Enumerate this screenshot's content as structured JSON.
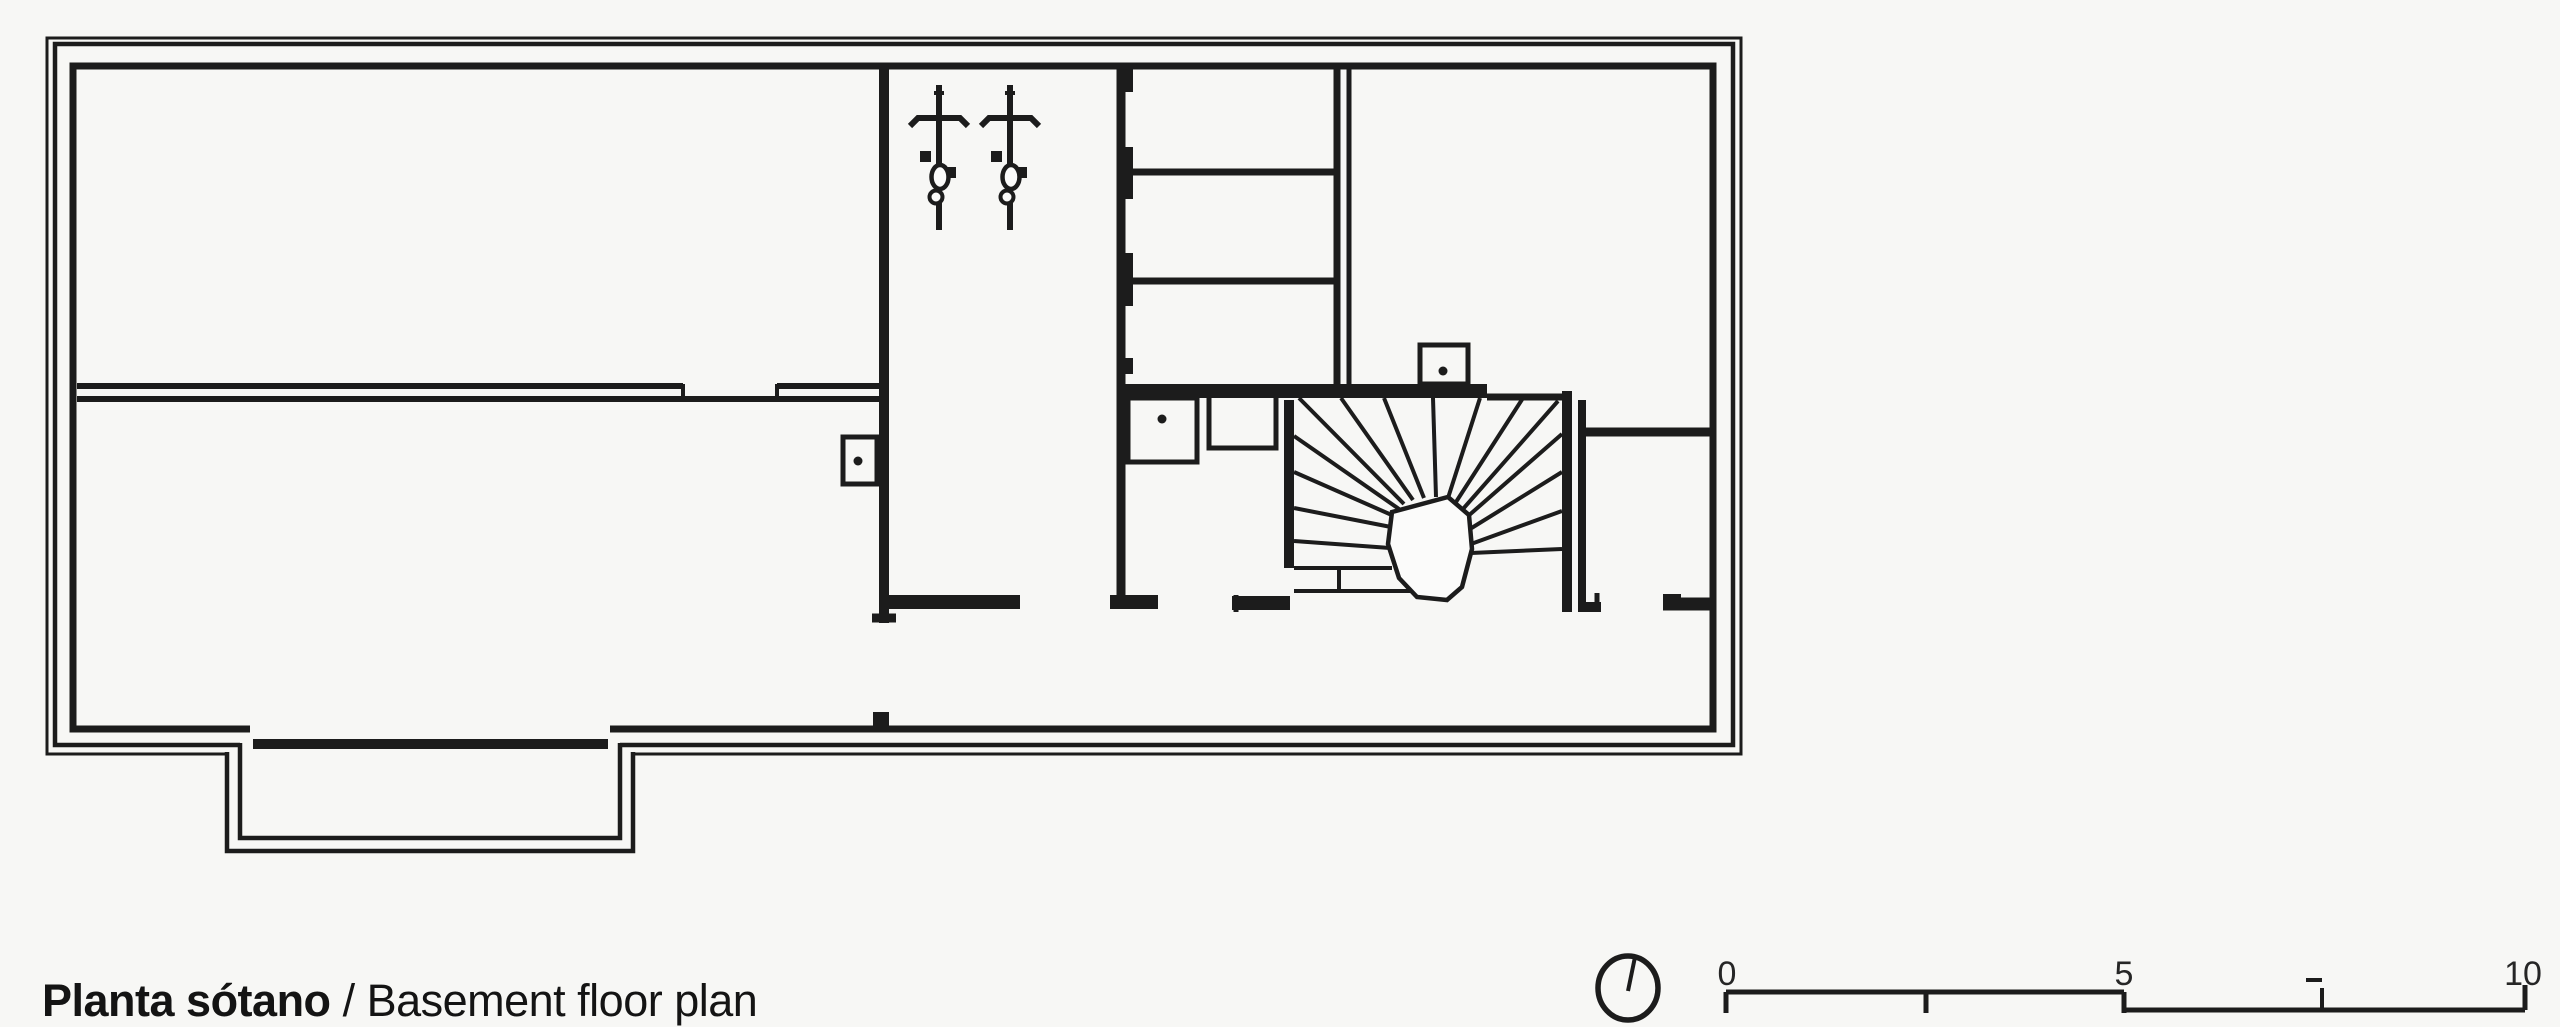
{
  "page": {
    "background": "#f7f7f5",
    "ink": "#1c1c1c",
    "paper": "#fbfbfa"
  },
  "caption": {
    "bold": "Planta sótano ",
    "regular": "/ Basement floor plan"
  },
  "scale_bar": {
    "labels": [
      "0",
      "5",
      "10"
    ]
  },
  "drawing": {
    "type": "architectural-floor-plan",
    "level": "basement",
    "symbols": {
      "north_indicator": "north-indicator-icon",
      "bicycle_count": 2,
      "column_boxes": 3,
      "winder_stair": "fan-stair-icon",
      "storage_shelves": 2,
      "lightwell": "window-well"
    }
  }
}
